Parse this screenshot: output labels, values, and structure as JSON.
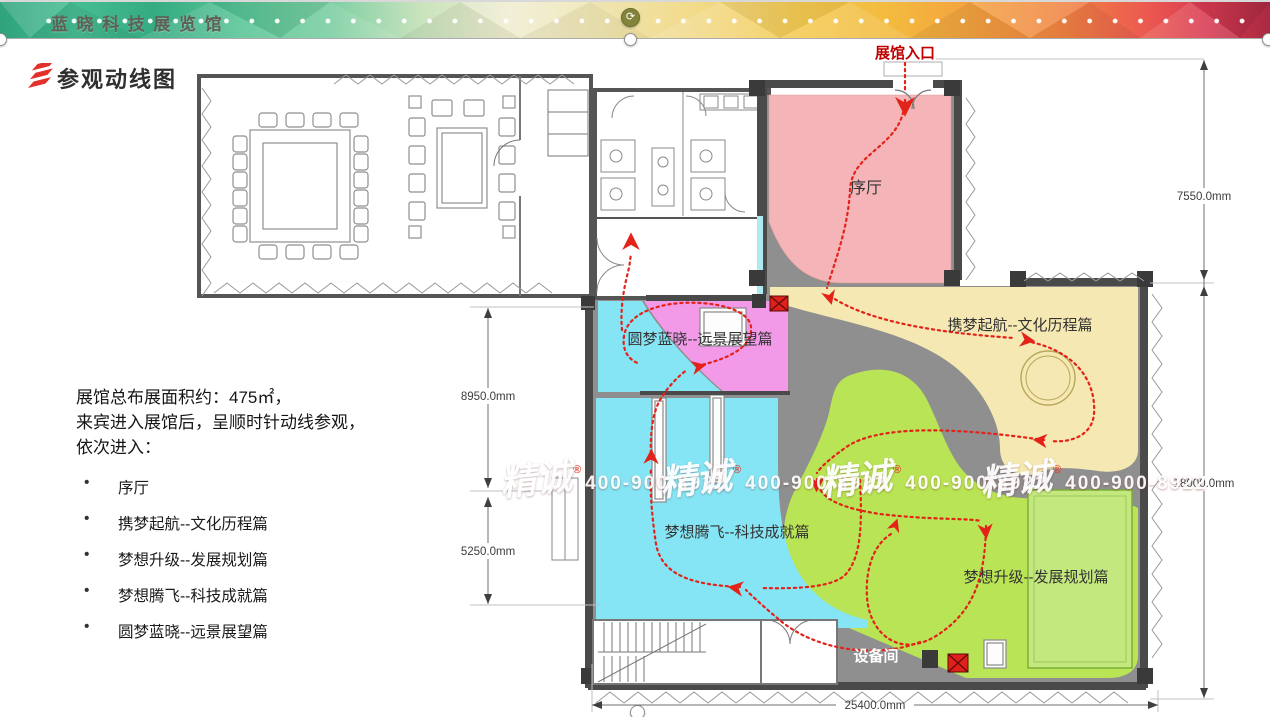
{
  "banner": {
    "title": "蓝晓科技展览馆"
  },
  "page": {
    "title": "参观动线图"
  },
  "intro": {
    "line1": "展馆总布展面积约：475㎡，",
    "line2": "来宾进入展馆后，呈顺时针动线参观，",
    "line3": "依次进入：",
    "bullets": [
      "序厅",
      "携梦起航--文化历程篇",
      "梦想升级--发展规划篇",
      "梦想腾飞--科技成就篇",
      "圆梦蓝晓--远景展望篇"
    ]
  },
  "plan": {
    "entrance_label": "展馆入口",
    "equipment_room": "设备间",
    "zones": [
      {
        "name": "序厅",
        "color": "#f4b4b8"
      },
      {
        "name": "携梦起航--文化历程篇",
        "color": "#f6e8b2"
      },
      {
        "name": "圆梦蓝晓--远景展望篇",
        "color": "#f29ae8"
      },
      {
        "name": "梦想腾飞--科技成就篇",
        "color": "#85e5f4"
      },
      {
        "name": "梦想升级--发展规划篇",
        "color": "#b9e455"
      }
    ],
    "corridor_color": "#8f8f8f",
    "flow_color": "#e32219",
    "dimensions": {
      "right_top": "7550.0mm",
      "right_bottom": "18000.0mm",
      "left_top": "8950.0mm",
      "left_bottom": "5250.0mm",
      "bottom": "25400.0mm"
    }
  },
  "watermark": {
    "brand": "精诚",
    "reg": "®",
    "phone": "400-900-8922"
  }
}
